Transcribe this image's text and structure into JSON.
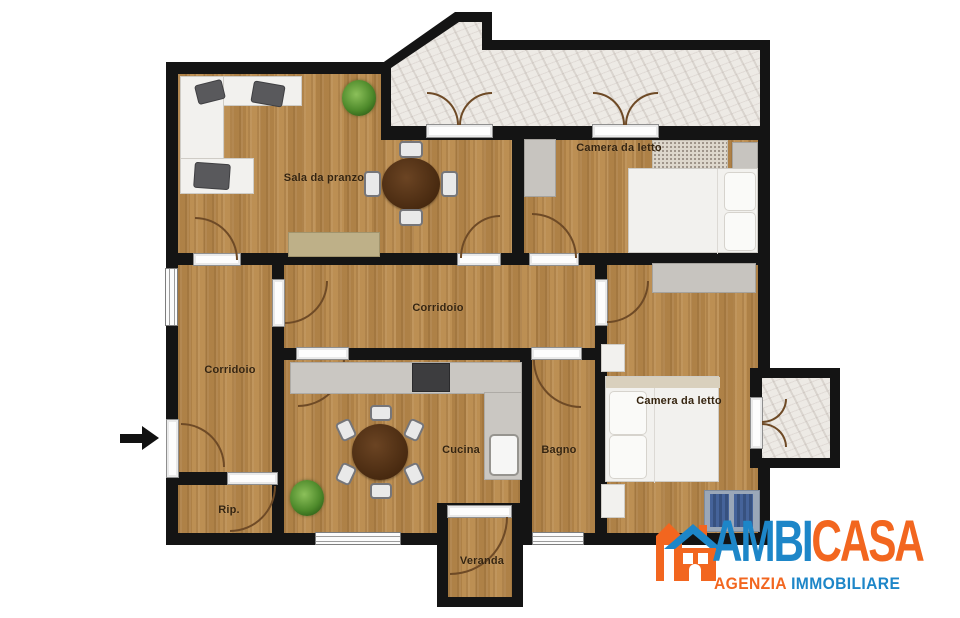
{
  "plan": {
    "rooms": [
      {
        "name": "sala-da-pranzo",
        "label": "Sala da pranzo"
      },
      {
        "name": "camera-da-letto-nord",
        "label": "Camera da letto"
      },
      {
        "name": "corridoio-centrale",
        "label": "Corridoio"
      },
      {
        "name": "corridoio-ingresso",
        "label": "Corridoio"
      },
      {
        "name": "cucina",
        "label": "Cucina"
      },
      {
        "name": "bagno",
        "label": "Bagno"
      },
      {
        "name": "camera-da-letto-sud",
        "label": "Camera da letto"
      },
      {
        "name": "ripostiglio",
        "label": "Rip."
      },
      {
        "name": "veranda",
        "label": "Veranda"
      }
    ],
    "icons": {
      "entrance_arrow": "right-arrow"
    },
    "palette": {
      "wall": "#141414",
      "wood_floor": "#b8894c",
      "marble_floor": "#edeae5"
    }
  },
  "branding": {
    "name_primary": "AMBI",
    "name_secondary": "CASA",
    "tagline_primary": "AGENZIA",
    "tagline_secondary": "IMMOBILIARE",
    "colors": {
      "blue": "#1d86c8",
      "orange": "#f2661f"
    }
  }
}
